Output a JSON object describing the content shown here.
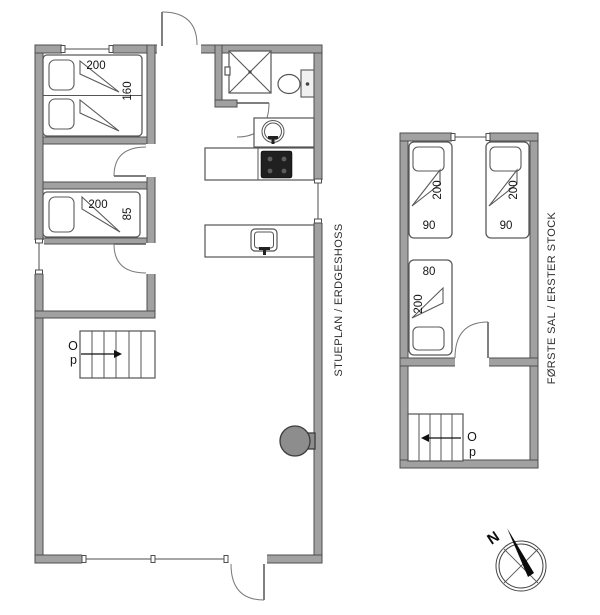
{
  "ground_floor": {
    "title": "STUEPLAN / ERDGESHOSS",
    "double_bed": {
      "length_label": "200",
      "width_label": "160"
    },
    "single_bed": {
      "length_label": "200",
      "width_label": "85"
    },
    "stairs": {
      "up_letter_top": "O",
      "up_letter_bottom": "p"
    }
  },
  "first_floor": {
    "title": "FØRSTE SAL / ERSTER STOCK",
    "bed_top_left": {
      "length_label": "200",
      "width_label": "90"
    },
    "bed_top_right": {
      "length_label": "200",
      "width_label": "90"
    },
    "bed_lower": {
      "length_label": "200",
      "width_label": "80"
    },
    "stairs": {
      "up_letter_top": "O",
      "up_letter_bottom": "p"
    }
  },
  "compass": {
    "north_label": "N"
  },
  "colors": {
    "background": "#ffffff",
    "wall_fill": "#a1a1a1",
    "wall_outline": "#4e4e4e",
    "cooktop": "#202020",
    "wood_stove": "#8d8d8d",
    "text": "#141414"
  }
}
